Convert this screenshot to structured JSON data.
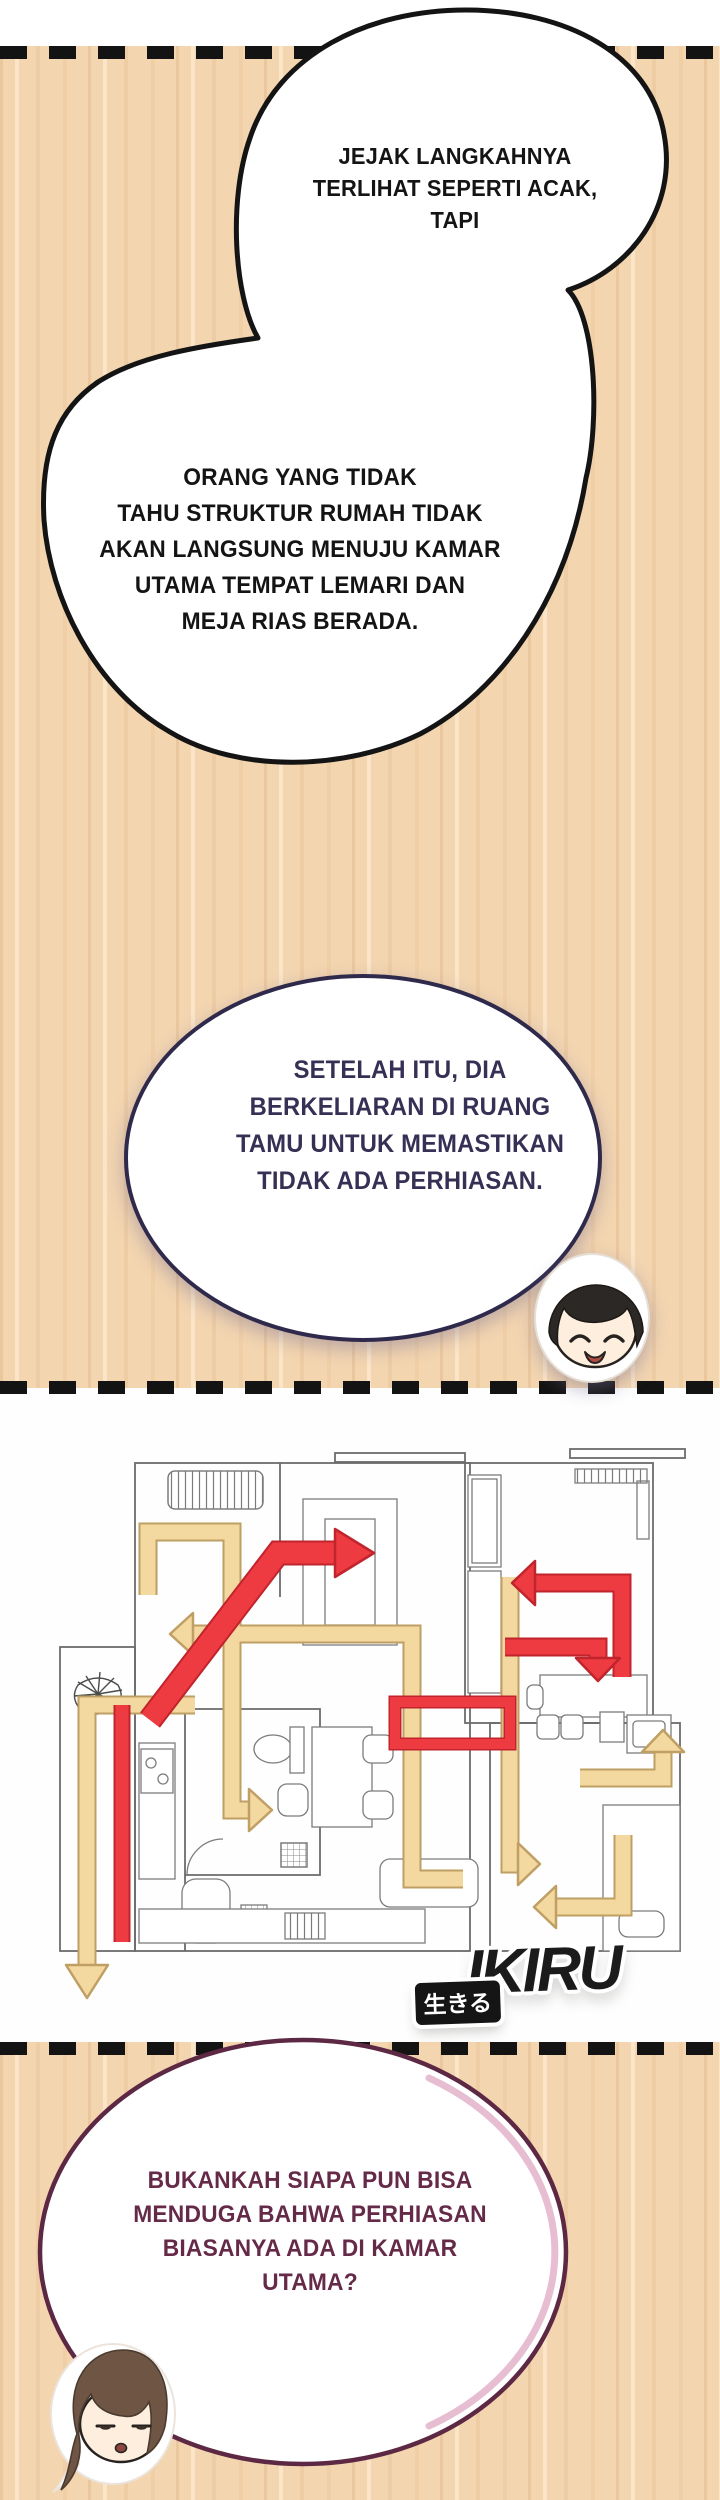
{
  "page": {
    "background": "#ffffff",
    "wood_color": "#f3d5b0",
    "panel_border_color": "#131313"
  },
  "panel_top": {
    "bubble_main": {
      "text_top": "JEJAK LANGKAHNYA\nTERLIHAT SEPERTI ACAK,\nTAPI",
      "text_bottom": "ORANG YANG TIDAK\nTAHU STRUKTUR RUMAH TIDAK\nAKAN LANGSUNG MENUJU KAMAR\nUTAMA TEMPAT LEMARI DAN\nMEJA RIAS BERADA.",
      "outline_color": "#141414",
      "text_color": "#141414"
    },
    "bubble_second": {
      "text": "SETELAH ITU, DIA\nBERKELIARAN DI RUANG\nTAMU UNTUK MEMASTIKAN\nTIDAK ADA PERHIASAN.",
      "outline_color": "#2f2a4b",
      "text_color": "#363055"
    }
  },
  "map_panel": {
    "direct_route_color": "#ee3a41",
    "direct_route_edge_color": "#c0242c",
    "wander_route_color": "#f3d8a0",
    "wander_route_edge_color": "#bf9f63",
    "wall_color": "#6b6b6b",
    "logo": {
      "badge_text": "生きる",
      "logo_text": "IKIRU"
    }
  },
  "panel_bottom": {
    "bubble": {
      "text": "BUKANKAH SIAPA PUN BISA\nMENDUGA BAHWA PERHIASAN\nBIASANYA ADA DI KAMAR\nUTAMA?",
      "outline_color": "#5d2843",
      "accent_color": "#e3b2ca",
      "text_color": "#662a49"
    }
  }
}
